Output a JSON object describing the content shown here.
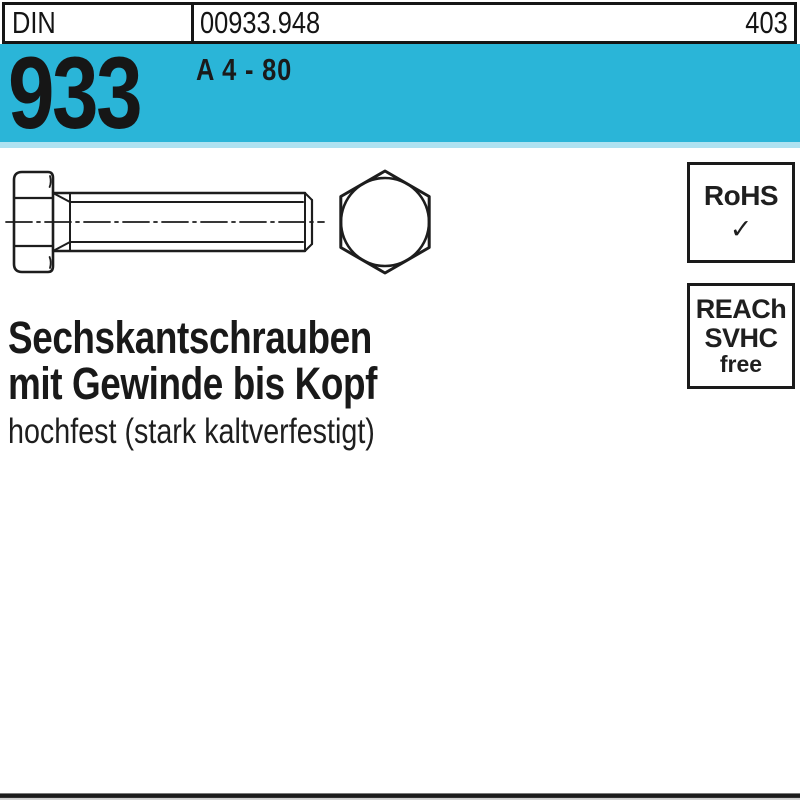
{
  "header": {
    "din_label": "DIN",
    "article_number": "00933.948",
    "page_number": "403"
  },
  "banner": {
    "standard_number": "933",
    "material_grade": "A 4 - 80",
    "color": "#2ab5d8",
    "light_strip_color": "#aee2f1"
  },
  "badges": {
    "rohs": {
      "label": "RoHS",
      "check": "✓"
    },
    "reach": {
      "line1": "REACh",
      "line2": "SVHC",
      "line3": "free"
    }
  },
  "product": {
    "title_line1": "Sechskantschrauben",
    "title_line2": "mit Gewinde bis Kopf",
    "subtitle": "hochfest (stark kaltverfestigt)"
  },
  "drawing": {
    "name": "hex-bolt-technical-drawing",
    "views": [
      "side-view-with-thread",
      "hex-head-front-view"
    ],
    "line_color": "#1d1d1d"
  }
}
